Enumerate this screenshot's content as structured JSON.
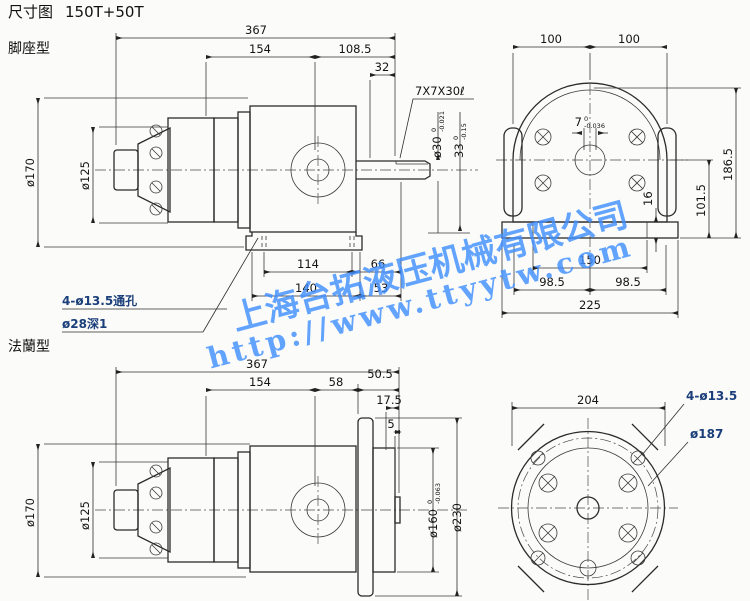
{
  "title": {
    "label": "尺寸图",
    "model": "150T+50T"
  },
  "sections": {
    "foot_label": "脚座型",
    "flange_label": "法蘭型"
  },
  "watermark": {
    "company": "上海台拓液压机械有限公司",
    "url": "http://www.ttyytw.com"
  },
  "colors": {
    "ink": "#222222",
    "watermark": "#408fff",
    "callout": "#1b3f7a",
    "paper": "#fbfbf9"
  },
  "foot_view": {
    "top_dims": {
      "overall": "367",
      "d154": "154",
      "d108_5": "108.5",
      "d32": "32"
    },
    "key_label": "7X7X30ℓ",
    "shaft": {
      "dia": "ø30",
      "dia_tol_up": "0",
      "dia_tol_dn": "-0.021",
      "key_h": "33",
      "key_h_tol_up": "0",
      "key_h_tol_dn": "-0.15"
    },
    "left_dims": {
      "d170": "ø170",
      "d125": "ø125"
    },
    "bottom_dims": {
      "d114": "114",
      "d66": "66",
      "d140": "140",
      "d53": "53"
    },
    "callouts": {
      "holes": "4-ø13.5通孔",
      "recess": "ø28深1"
    },
    "rear": {
      "d100L": "100",
      "d100R": "100",
      "d186_5": "186.5",
      "d101_5": "101.5",
      "d16": "16",
      "d150": "150",
      "d98_5L": "98.5",
      "d98_5R": "98.5",
      "d225": "225",
      "key_w": "7",
      "key_w_tol_up": "0",
      "key_w_tol_dn": "-0.036"
    }
  },
  "flange_view": {
    "top_dims": {
      "overall": "367",
      "d154": "154",
      "d58": "58",
      "d50_5": "50.5",
      "d17_5": "17.5",
      "d5": "5"
    },
    "left_dims": {
      "d170": "ø170",
      "d125": "ø125"
    },
    "right_dims": {
      "d160": "ø160",
      "d160_tol_up": "0",
      "d160_tol_dn": "-0.063",
      "d230": "ø230"
    },
    "circle": {
      "d204": "204",
      "holes": "4-ø13.5",
      "bolt_circle": "ø187"
    }
  }
}
